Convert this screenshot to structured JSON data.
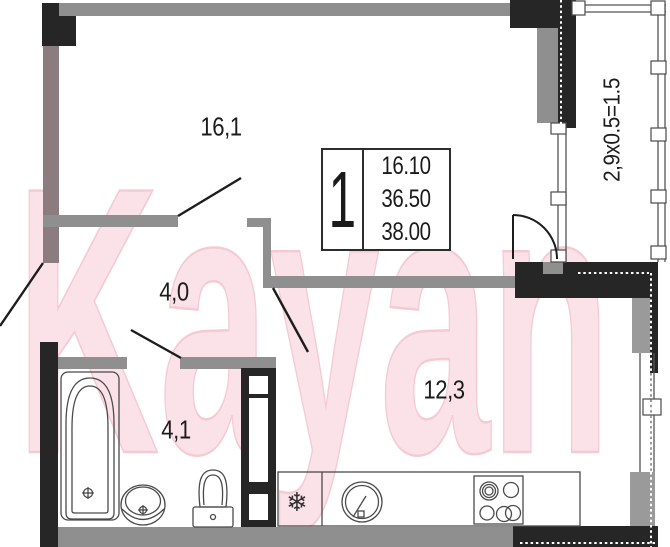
{
  "watermark": {
    "text": "Kayan",
    "fill": "#fadee4",
    "edge": "#f3c2cd"
  },
  "rooms": {
    "living": {
      "area_label": "16,1"
    },
    "hallway": {
      "area_label": "4,0"
    },
    "bathroom": {
      "area_label": "4,1"
    },
    "kitchen": {
      "area_label": "12,3"
    }
  },
  "balcony": {
    "dimension_label": "2,9x0.5=1.5"
  },
  "stamp": {
    "rooms_count": "1",
    "values": [
      "16.10",
      "36.50",
      "38.00"
    ]
  },
  "icons": {
    "fridge_glyph": "❄"
  },
  "colors": {
    "wall_gray": "#8f8f8f",
    "wall_taupe": "#8b7c80",
    "wall_black": "#262626",
    "line_dark": "#2a2a2a",
    "fixture_line": "#4a4a4a",
    "watermark_pink": "#f7d2da"
  }
}
